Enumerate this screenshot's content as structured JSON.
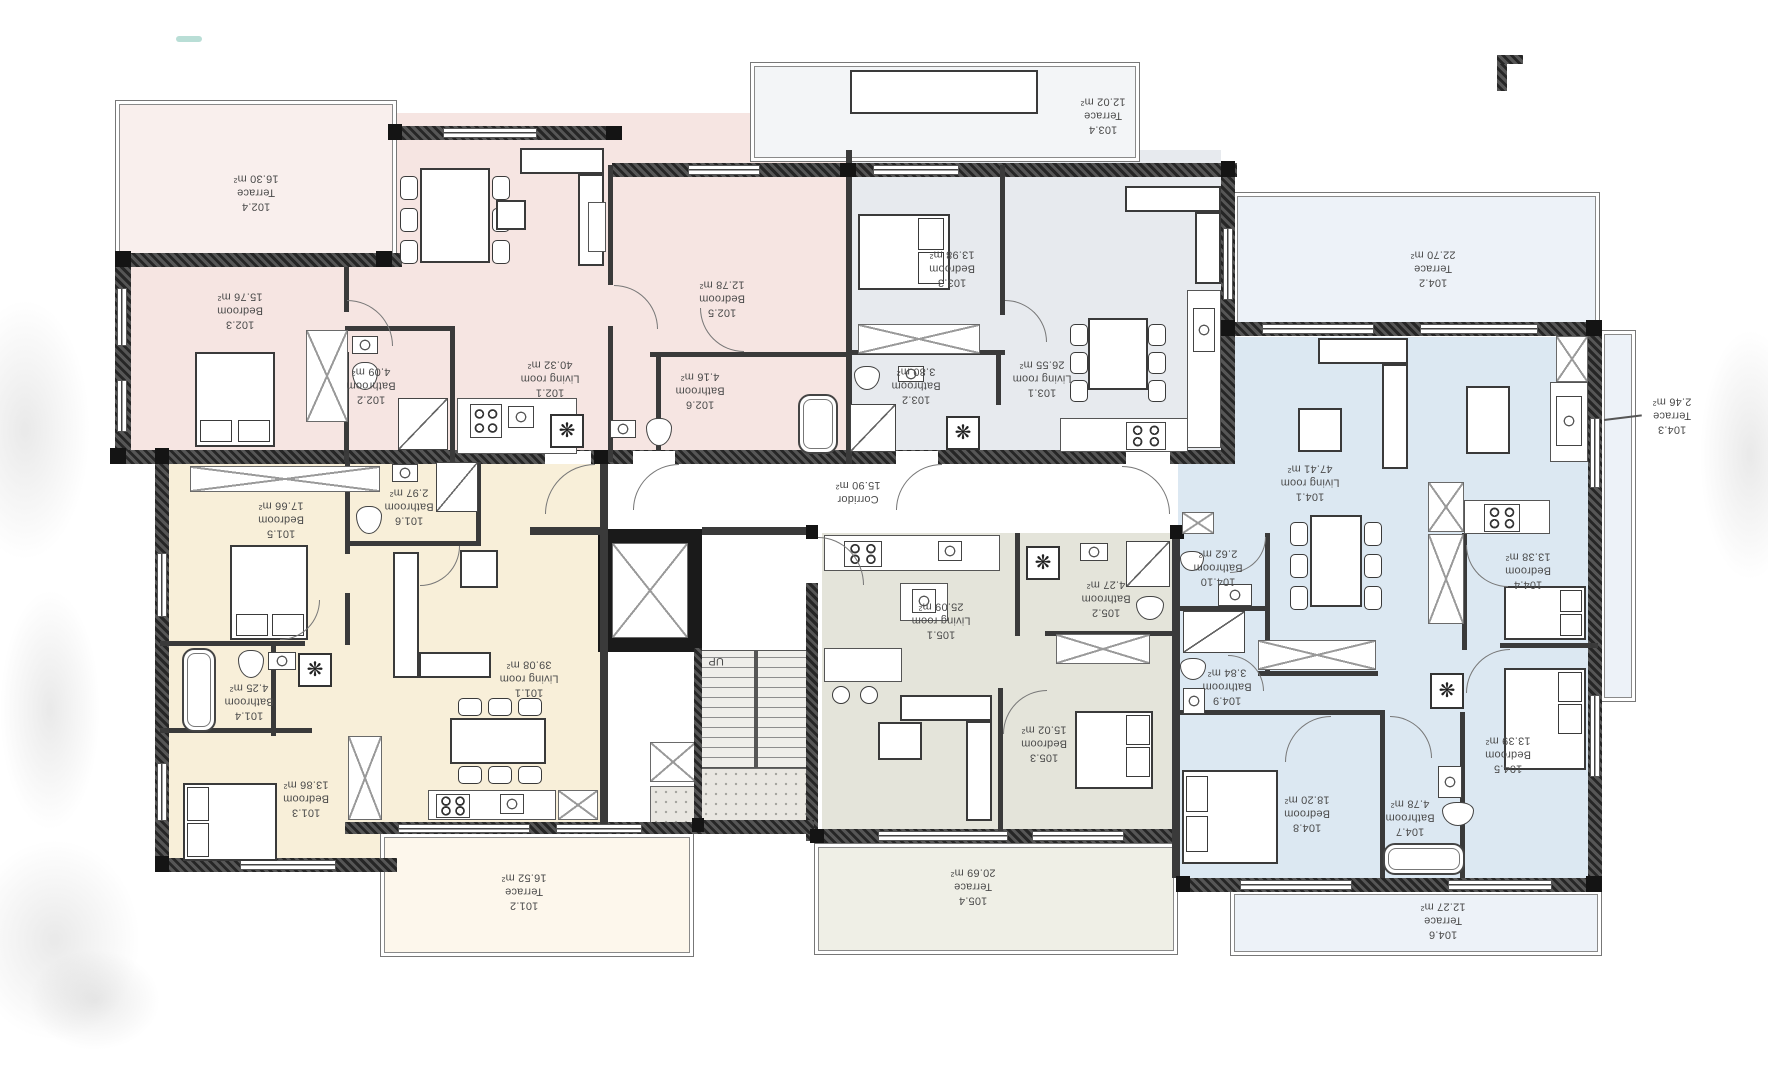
{
  "icons": {
    "fan": "❋"
  },
  "core": {
    "corridor": {
      "name": "Corridor",
      "area": "15.90 m²"
    },
    "stairs_label": "UP"
  },
  "apartments": [
    {
      "id": "101",
      "accent": "#f8efd9",
      "rooms": [
        {
          "id": "101.1",
          "name": "Living room",
          "area": "39.08 m²"
        },
        {
          "id": "101.2",
          "name": "Terrace",
          "area": "16.52 m²"
        },
        {
          "id": "101.3",
          "name": "Bedroom",
          "area": "13.86 m²"
        },
        {
          "id": "101.4",
          "name": "Bathroom",
          "area": "4.25 m²"
        },
        {
          "id": "101.5",
          "name": "Bedroom",
          "area": "17.66 m²"
        },
        {
          "id": "101.6",
          "name": "Bathroom",
          "area": "2.97 m²"
        }
      ]
    },
    {
      "id": "102",
      "accent": "#f6e5e2",
      "rooms": [
        {
          "id": "102.1",
          "name": "Living room",
          "area": "40.32 m²"
        },
        {
          "id": "102.2",
          "name": "Bathroom",
          "area": "4.09 m²"
        },
        {
          "id": "102.3",
          "name": "Bedroom",
          "area": "15.76 m²"
        },
        {
          "id": "102.4",
          "name": "Terrace",
          "area": "16.30 m²"
        },
        {
          "id": "102.5",
          "name": "Bedroom",
          "area": "12.78 m²"
        },
        {
          "id": "102.6",
          "name": "Bathroom",
          "area": "4.16 m²"
        }
      ]
    },
    {
      "id": "103",
      "accent": "#e7eaee",
      "rooms": [
        {
          "id": "103.1",
          "name": "Living room",
          "area": "26.55 m²"
        },
        {
          "id": "103.2",
          "name": "Bathroom",
          "area": "3.80 m²"
        },
        {
          "id": "103.3",
          "name": "Bedroom",
          "area": "13.98 m²"
        },
        {
          "id": "103.4",
          "name": "Terrace",
          "area": "12.02 m²"
        }
      ]
    },
    {
      "id": "104",
      "accent": "#dce8f2",
      "rooms": [
        {
          "id": "104.1",
          "name": "Living room",
          "area": "47.41 m²"
        },
        {
          "id": "104.2",
          "name": "Terrace",
          "area": "22.70 m²"
        },
        {
          "id": "104.3",
          "name": "Terrace",
          "area": "2.46 m²"
        },
        {
          "id": "104.4",
          "name": "Bedroom",
          "area": "13.38 m²"
        },
        {
          "id": "104.5",
          "name": "Bedroom",
          "area": "13.39 m²"
        },
        {
          "id": "104.6",
          "name": "Terrace",
          "area": "12.27 m²"
        },
        {
          "id": "104.7",
          "name": "Bathroom",
          "area": "4.78 m²"
        },
        {
          "id": "104.8",
          "name": "Bedroom",
          "area": "18.20 m²"
        },
        {
          "id": "104.9",
          "name": "Bathroom",
          "area": "3.84 m²"
        },
        {
          "id": "104.10",
          "name": "Bathroom",
          "area": "2.62 m²"
        }
      ]
    },
    {
      "id": "105",
      "accent": "#e4e4da",
      "rooms": [
        {
          "id": "105.1",
          "name": "Living room",
          "area": "25.09 m²"
        },
        {
          "id": "105.2",
          "name": "Bathroom",
          "area": "4.27 m²"
        },
        {
          "id": "105.3",
          "name": "Bedroom",
          "area": "15.02 m²"
        },
        {
          "id": "105.4",
          "name": "Terrace",
          "area": "20.69 m²"
        }
      ]
    }
  ]
}
